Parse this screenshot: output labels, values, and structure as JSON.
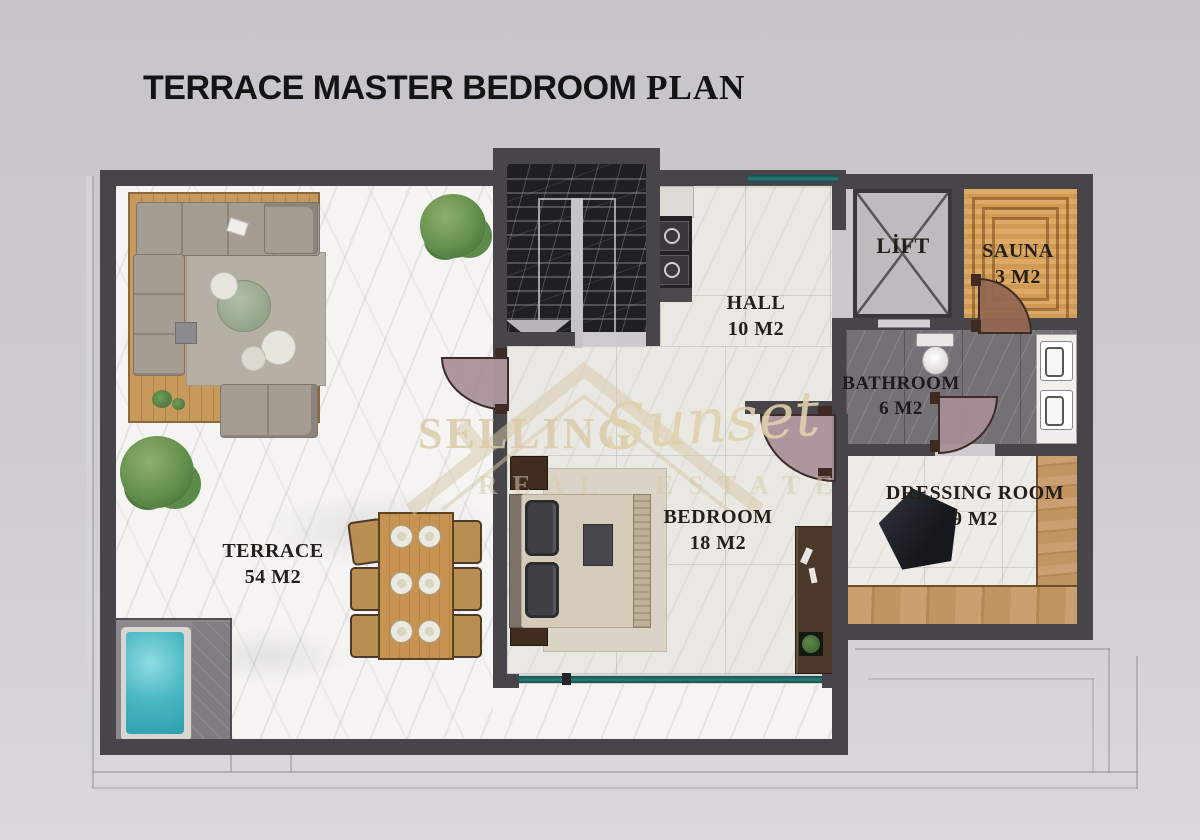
{
  "title": {
    "main": "TERRACE MASTER BEDROOM",
    "suffix": " PLAN"
  },
  "watermark": {
    "word1": "SELLING",
    "word2": "Sunset",
    "word3": "REAL ESTATE"
  },
  "rooms": {
    "terrace": {
      "name": "TERRACE",
      "area": "54 M2"
    },
    "hall": {
      "name": "HALL",
      "area": "10 M2"
    },
    "lift": {
      "name": "LİFT",
      "area": ""
    },
    "sauna": {
      "name": "SAUNA",
      "area": "3 M2"
    },
    "bathroom": {
      "name": "BATHROOM",
      "area": "6 M2"
    },
    "dressing": {
      "name": "DRESSING ROOM",
      "area": "9 M2"
    },
    "bedroom": {
      "name": "BEDROOM",
      "area": "18 M2"
    }
  },
  "colors": {
    "background": "#cbc9cd",
    "wall": "#47454a",
    "terrace_marble": "#f5f4f2",
    "interior_marble": "#eae8e2",
    "stair_marble": "#201f23",
    "bathroom_floor": "#747176",
    "deck_wood": "#c79a5c",
    "sauna_wood": "#d8a25e",
    "window_glass": "#1d6462",
    "jacuzzi_water": "#49b6c1",
    "door_leaf": "#a78f98",
    "watermark": "#d8caa8",
    "label_text": "#241f19"
  }
}
